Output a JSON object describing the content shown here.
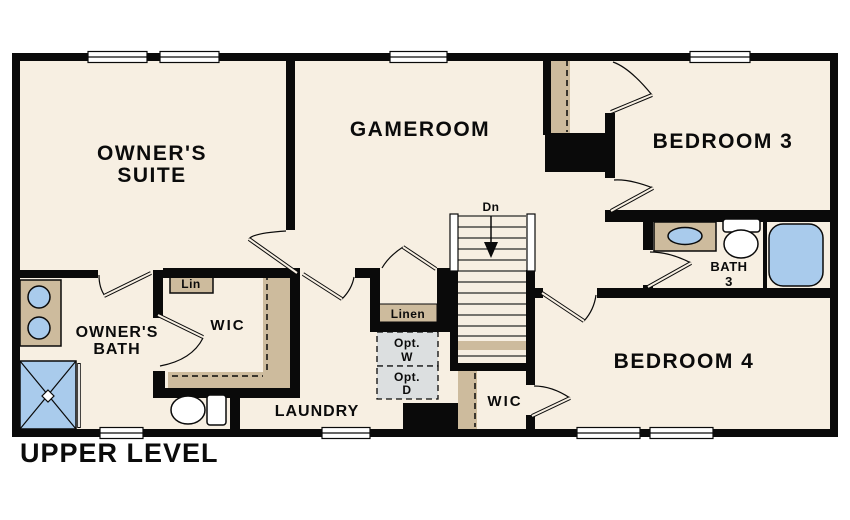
{
  "title": "UPPER LEVEL",
  "colors": {
    "wall": "#0a0a0a",
    "floor": "#f7efe2",
    "shelf": "#cdbb9d",
    "fixture_blue": "#a9cbec",
    "opt_fill": "#dcdfe0",
    "window_fill": "#ffffff"
  },
  "rooms": {
    "owner_suite": {
      "lines": [
        "OWNER'S",
        "SUITE"
      ]
    },
    "gameroom": {
      "label": "GAMEROOM"
    },
    "bedroom3": {
      "label": "BEDROOM 3"
    },
    "bedroom4": {
      "label": "BEDROOM 4"
    },
    "owner_bath": {
      "lines": [
        "OWNER'S",
        "BATH"
      ]
    },
    "bath3": {
      "lines": [
        "BATH",
        "3"
      ]
    },
    "laundry": {
      "label": "LAUNDRY"
    },
    "wic_owner": {
      "label": "WIC"
    },
    "wic_bedroom4": {
      "label": "WIC"
    },
    "linen_hall": {
      "label": "Linen"
    },
    "linen_small": {
      "label": "Lin"
    }
  },
  "annotations": {
    "stairs_direction": "Dn",
    "optional_washer": [
      "Opt.",
      "W"
    ],
    "optional_dryer": [
      "Opt.",
      "D"
    ]
  }
}
